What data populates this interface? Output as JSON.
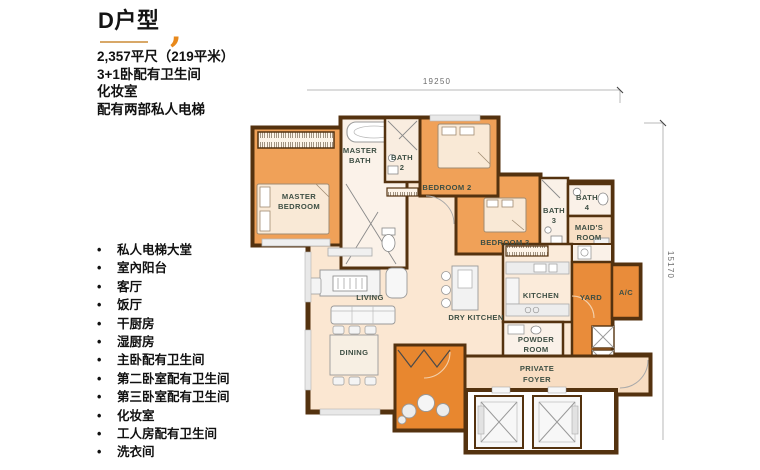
{
  "header": {
    "title": "D户型",
    "accent_mark": ",",
    "specs": [
      "2,357平尺（219平米）",
      "3+1卧配有卫生间",
      "化妆室",
      "配有两部私人电梯"
    ]
  },
  "bullet_char": "•",
  "features": [
    "私人电梯大堂",
    "室內阳台",
    "客厅",
    "饭厅",
    "干厨房",
    "湿厨房",
    "主卧配有卫生间",
    "第二卧室配有卫生间",
    "第三卧室配有卫生间",
    "化妆室",
    "工人房配有卫生间",
    "洗衣间"
  ],
  "plan": {
    "dimensions": {
      "top": "19250",
      "right": "15170"
    },
    "rooms": {
      "master_bedroom": [
        "MASTER",
        "BEDROOM"
      ],
      "master_bath": [
        "MASTER",
        "BATH"
      ],
      "bath_2": [
        "BATH",
        "2"
      ],
      "bedroom_2": [
        "BEDROOM 2"
      ],
      "bedroom_3": [
        "BEDROOM 3"
      ],
      "bath_3": [
        "BATH",
        "3"
      ],
      "bath_4": [
        "BATH",
        "4"
      ],
      "maids_room": [
        "MAID'S",
        "ROOM"
      ],
      "living": [
        "LIVING"
      ],
      "dining": [
        "DINING"
      ],
      "dry_kitchen": [
        "DRY KITCHEN"
      ],
      "kitchen": [
        "KITCHEN"
      ],
      "yard": [
        "YARD"
      ],
      "ac": [
        "A/C"
      ],
      "powder_room": [
        "POWDER",
        "ROOM"
      ],
      "private_foyer": [
        "PRIVATE",
        "FOYER"
      ]
    },
    "colors": {
      "accent_orange": "#E8891C",
      "wall_brown": "#54320F",
      "bedroom_orange": "#F0A158",
      "balcony_orange": "#E8872F",
      "floor_peach": "#FBE7D2",
      "foyer_peach": "#F8DDC2",
      "bath_cream": "#FAF1E8",
      "label_green": "#3E4F44"
    }
  }
}
